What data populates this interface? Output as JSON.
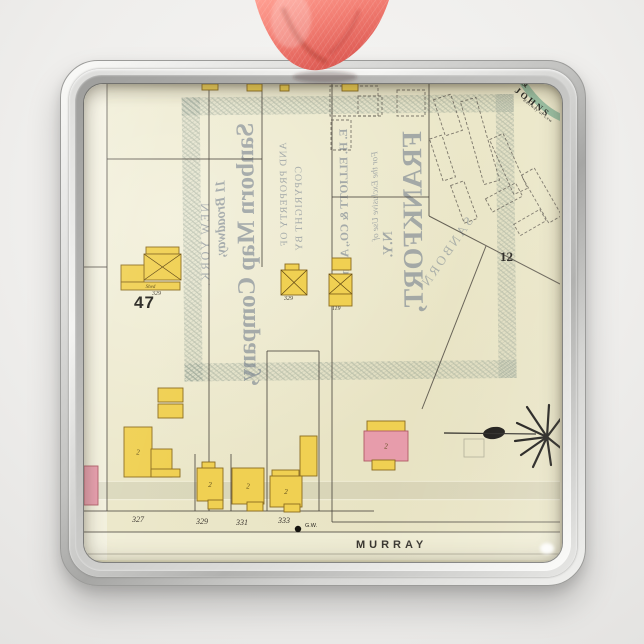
{
  "scene": {
    "description": "Square chrome photo ornament with coral satin ribbon, printed with a vintage Sanborn fire-insurance map sheet",
    "ribbon_color": "#ef7065",
    "frame_color": "#c6c6c4",
    "background_color": "#f1f0ee"
  },
  "map": {
    "street_label": "MURRAY",
    "block_number": "47",
    "page_number": "12",
    "well_label": "G.W.",
    "corner_arc_text": "& JOHNS",
    "corner_arc_subtext": "Railway of Lew",
    "house_numbers": [
      "327",
      "329",
      "331",
      "333"
    ],
    "captions": {
      "barn": "329",
      "mid": "329",
      "right": "119"
    },
    "ghost_text": {
      "copyright": "COPYRIGHT BY",
      "property": "AND PROPERTY OF",
      "company": "Sanborn Map Company,",
      "broadway": "11 Broadway,",
      "newyork": "NEW YORK.",
      "elliott": "E. H. ELLIOTT & CO., Agent",
      "exclusive": "For the Exclusive Use of",
      "frankfort": "FRANKFORT,",
      "ny": "N.Y.",
      "sanborn_diag": "SANBORN"
    },
    "colors": {
      "paper": "#ebe7c9",
      "building_frame": "#f0d052",
      "building_brick": "#e79cab",
      "outline": "#8a6b1f",
      "brick_outline": "#b05a64",
      "line": "#46413a",
      "ink": "#2a2823",
      "green_band": "#7fb092"
    },
    "geometry": {
      "buildings": [
        {
          "x": 118,
          "y": 0,
          "w": 16,
          "h": 6,
          "f": "y"
        },
        {
          "x": 163,
          "y": 0,
          "w": 15,
          "h": 7,
          "f": "y"
        },
        {
          "x": 196,
          "y": 1,
          "w": 9,
          "h": 6,
          "f": "y"
        },
        {
          "x": 258,
          "y": 0,
          "w": 16,
          "h": 7,
          "f": "y"
        },
        {
          "x": 62,
          "y": 163,
          "w": 33,
          "h": 7,
          "f": "y"
        },
        {
          "x": 60,
          "y": 170,
          "w": 37,
          "h": 26,
          "f": "y",
          "m": true
        },
        {
          "x": 37,
          "y": 181,
          "w": 23,
          "h": 17,
          "f": "y"
        },
        {
          "x": 37,
          "y": 198,
          "w": 59,
          "h": 8,
          "f": "y",
          "l": "Shed",
          "ls": 5
        },
        {
          "x": 201,
          "y": 180,
          "w": 14,
          "h": 7,
          "f": "y"
        },
        {
          "x": 197,
          "y": 186,
          "w": 26,
          "h": 25,
          "f": "y",
          "m": true
        },
        {
          "x": 248,
          "y": 174,
          "w": 19,
          "h": 12,
          "f": "y"
        },
        {
          "x": 245,
          "y": 190,
          "w": 23,
          "h": 20,
          "f": "y",
          "m": true
        },
        {
          "x": 245,
          "y": 210,
          "w": 23,
          "h": 12,
          "f": "y"
        },
        {
          "x": 74,
          "y": 304,
          "w": 25,
          "h": 14,
          "f": "y"
        },
        {
          "x": 74,
          "y": 320,
          "w": 25,
          "h": 14,
          "f": "y"
        },
        {
          "x": 40,
          "y": 343,
          "w": 28,
          "h": 50,
          "f": "y",
          "l": "2",
          "ls": 7
        },
        {
          "x": 67,
          "y": 365,
          "w": 21,
          "h": 28,
          "f": "y"
        },
        {
          "x": 67,
          "y": 385,
          "w": 29,
          "h": 8,
          "f": "y"
        },
        {
          "x": 0,
          "y": 382,
          "w": 14,
          "h": 39,
          "f": "p"
        },
        {
          "x": 216,
          "y": 352,
          "w": 17,
          "h": 40,
          "f": "y"
        },
        {
          "x": 118,
          "y": 378,
          "w": 13,
          "h": 7,
          "f": "y"
        },
        {
          "x": 113,
          "y": 384,
          "w": 26,
          "h": 33,
          "f": "y",
          "l": "2",
          "ls": 7
        },
        {
          "x": 124,
          "y": 416,
          "w": 15,
          "h": 9,
          "f": "y"
        },
        {
          "x": 148,
          "y": 384,
          "w": 32,
          "h": 36,
          "f": "y",
          "l": "2",
          "ls": 7
        },
        {
          "x": 163,
          "y": 418,
          "w": 16,
          "h": 9,
          "f": "y"
        },
        {
          "x": 188,
          "y": 386,
          "w": 27,
          "h": 7,
          "f": "y"
        },
        {
          "x": 186,
          "y": 392,
          "w": 32,
          "h": 31,
          "f": "y",
          "l": "2",
          "ls": 7
        },
        {
          "x": 200,
          "y": 420,
          "w": 16,
          "h": 8,
          "f": "y"
        },
        {
          "x": 283,
          "y": 337,
          "w": 38,
          "h": 11,
          "f": "y"
        },
        {
          "x": 280,
          "y": 347,
          "w": 44,
          "h": 30,
          "f": "p",
          "l": "2",
          "ls": 7
        },
        {
          "x": 288,
          "y": 376,
          "w": 23,
          "h": 10,
          "f": "y"
        }
      ],
      "lines": [
        [
          23,
          0,
          23,
          427
        ],
        [
          125,
          0,
          125,
          427
        ],
        [
          178,
          0,
          178,
          183
        ],
        [
          248,
          0,
          248,
          438
        ],
        [
          23,
          75,
          178,
          75
        ],
        [
          0,
          183,
          23,
          183
        ],
        [
          248,
          113,
          345,
          113
        ],
        [
          345,
          0,
          345,
          132
        ],
        [
          345,
          132,
          476,
          200
        ],
        [
          402,
          162,
          338,
          325
        ],
        [
          183,
          267,
          235,
          267
        ],
        [
          183,
          267,
          183,
          427
        ],
        [
          235,
          267,
          235,
          427
        ],
        [
          111,
          370,
          111,
          427
        ],
        [
          147,
          370,
          147,
          427
        ],
        [
          0,
          427,
          290,
          427
        ],
        [
          0,
          448,
          476,
          448
        ],
        [
          248,
          438,
          476,
          438
        ],
        [
          0,
          470,
          476,
          470
        ]
      ],
      "dashed": [
        [
          246,
          2,
          48,
          30,
          0
        ],
        [
          247,
          36,
          20,
          30,
          0
        ],
        [
          274,
          12,
          24,
          20,
          0
        ],
        [
          313,
          6,
          28,
          26,
          0
        ],
        [
          355,
          12,
          18,
          38,
          -18
        ],
        [
          388,
          14,
          16,
          86,
          -16
        ],
        [
          417,
          50,
          15,
          60,
          -24
        ],
        [
          450,
          84,
          15,
          55,
          -30
        ],
        [
          352,
          52,
          13,
          44,
          -18
        ],
        [
          373,
          98,
          14,
          40,
          -20
        ],
        [
          403,
          106,
          34,
          15,
          -28
        ],
        [
          431,
          132,
          30,
          13,
          -30
        ]
      ],
      "starburst": {
        "cx": 463,
        "cy": 353,
        "rays": [
          [
            -20,
            -30
          ],
          [
            2,
            -32
          ],
          [
            18,
            -24
          ],
          [
            -30,
            -14
          ],
          [
            -32,
            4
          ],
          [
            -26,
            18
          ],
          [
            -14,
            30
          ],
          [
            4,
            28
          ],
          [
            20,
            16
          ]
        ],
        "blob": {
          "cx": 410,
          "cy": 349,
          "rx": 11,
          "ry": 6
        },
        "pipe": [
          360,
          349,
          452,
          350
        ],
        "square": [
          380,
          355,
          20,
          18
        ]
      },
      "arc_path": "M 436,-6 Q 454,24 478,34",
      "gw_dot": [
        214,
        445
      ]
    }
  }
}
